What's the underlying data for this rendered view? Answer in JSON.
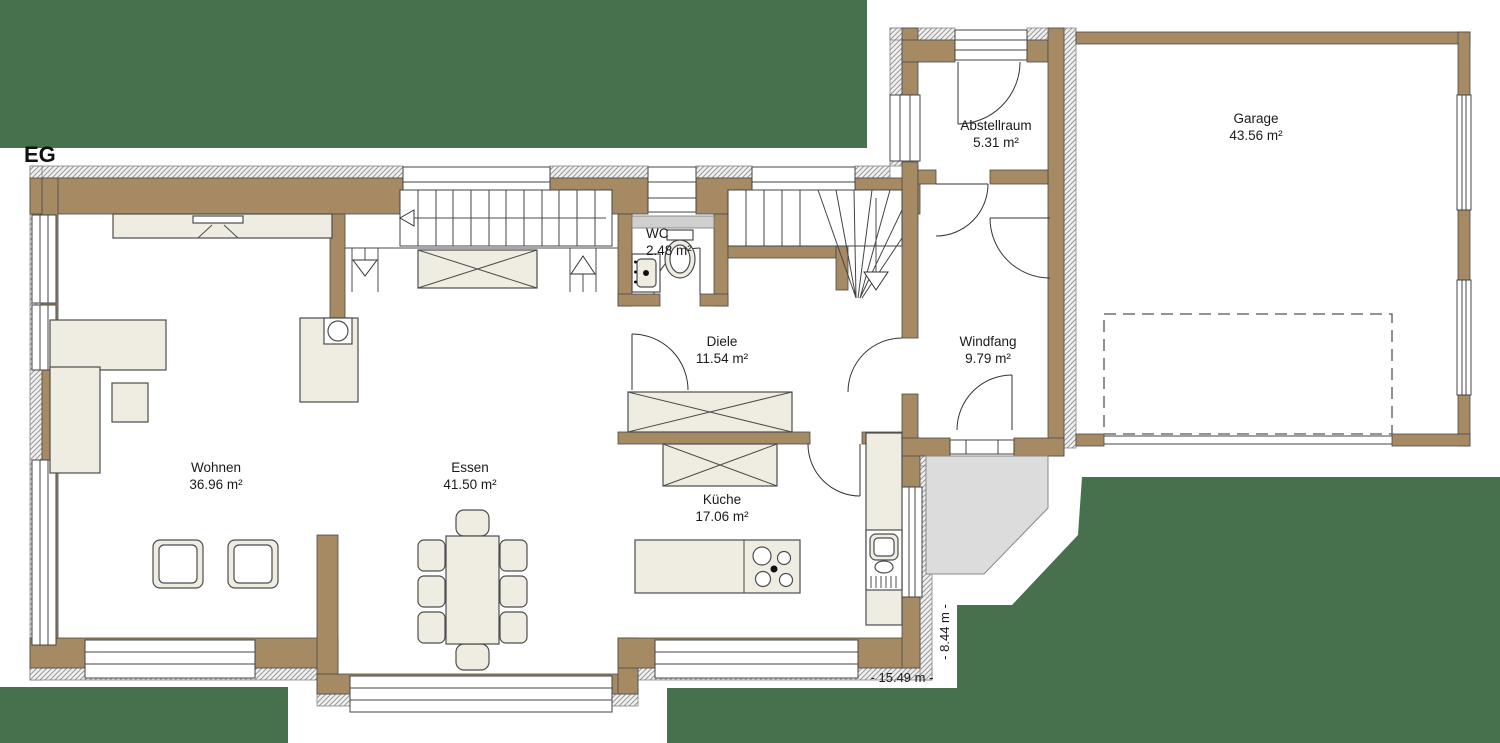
{
  "floor_label": "EG",
  "rooms": [
    {
      "name": "Wohnen",
      "area": "36.96 m²"
    },
    {
      "name": "Essen",
      "area": "41.50 m²"
    },
    {
      "name": "Küche",
      "area": "17.06 m²"
    },
    {
      "name": "Diele",
      "area": "11.54 m²"
    },
    {
      "name": "WC",
      "area": "2.48 m²"
    },
    {
      "name": "Windfang",
      "area": "9.79 m²"
    },
    {
      "name": "Abstellraum",
      "area": "5.31 m²"
    },
    {
      "name": "Garage",
      "area": "43.56 m²"
    }
  ],
  "dimensions": {
    "width_label": "- 15.49 m -",
    "depth_label": "- 8.44 m -"
  },
  "colors": {
    "background_green": "#47704c",
    "wall_brown": "#a58a63",
    "furniture_fill": "#efece1",
    "porch_gray": "#dcdcdc"
  }
}
